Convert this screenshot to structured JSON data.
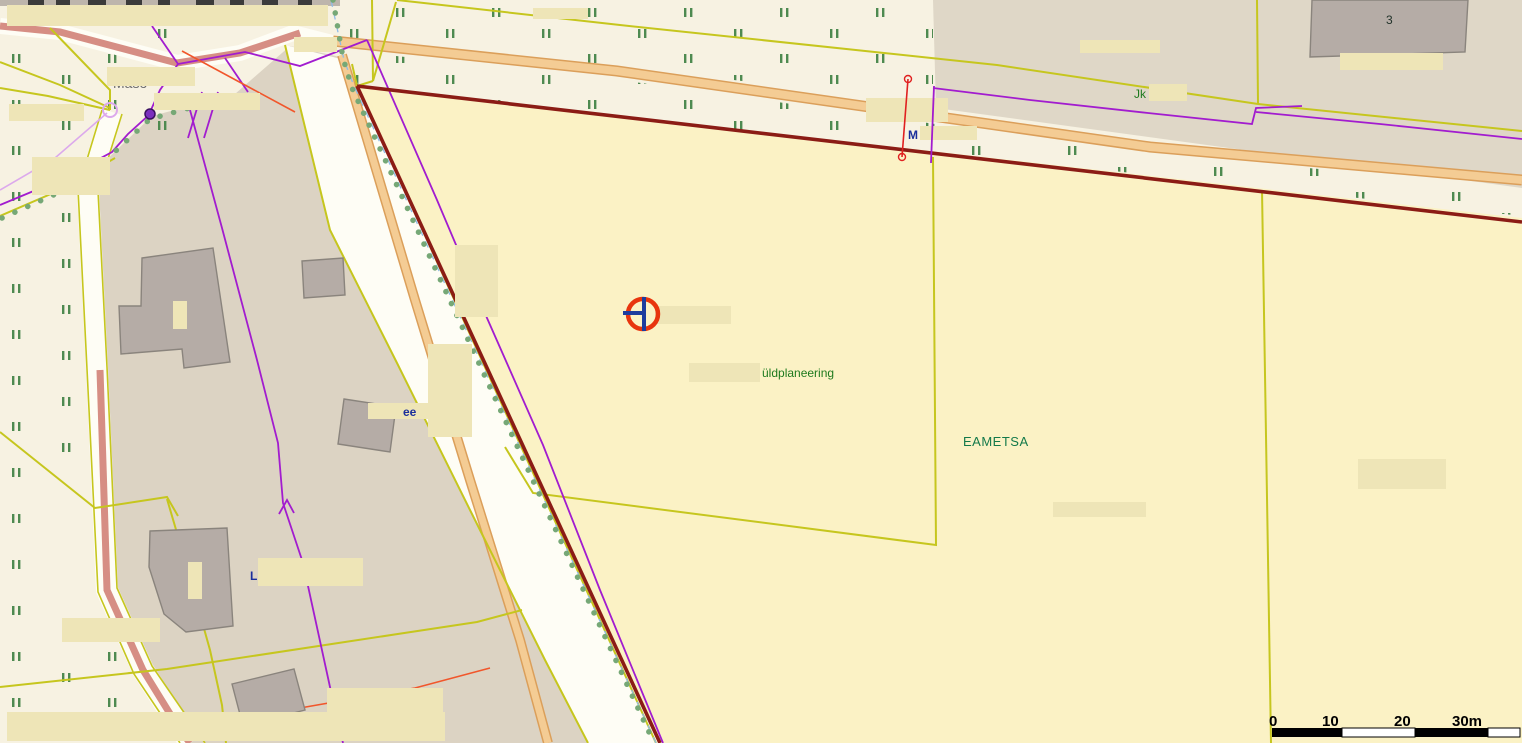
{
  "map": {
    "type": "cadastral-gis-map",
    "place_labels": {
      "planning_note": "üldplaneering",
      "area_name": "EAMETSA",
      "building_number": "3",
      "jk_abbrev": "Jk",
      "m_fragment": "M",
      "l_fragment": "L",
      "street_fragment": "ee",
      "road_partial": "Maso"
    },
    "scale_bar": {
      "labels": [
        "0",
        "10",
        "20",
        "30m"
      ],
      "unit": "m",
      "segment_meters": 10
    },
    "marker": {
      "kind": "crosshair-circle-survey-point",
      "ring_color": "#e8350e",
      "cross_color": "#1d3d9e"
    },
    "colors": {
      "base_cream": "#f7f2e2",
      "parcel_yellow": "#fbf2c5",
      "farmstead_tan": "#dcd3c3",
      "topright_tan": "#dfd7c7",
      "label_box": "#eee5b7",
      "building_fill": "#b5aca6",
      "building_stroke": "#8a847d",
      "boundary_dark_red": "#8b1c15",
      "parcel_line_yellow": "#c6c61e",
      "utility_purple": "#a21ccf",
      "lavender_line": "#dca9ec",
      "road_orange_fill": "#f4cc94",
      "road_orange_edge": "#db9f5a",
      "road_salmon": "#d68e84",
      "tree_dot_green": "#76a876",
      "veg_tick_green": "#4e8a50",
      "ditch_blue_dash": "#8fbce8",
      "measure_red": "#e02020",
      "scale_black": "#000000"
    }
  }
}
